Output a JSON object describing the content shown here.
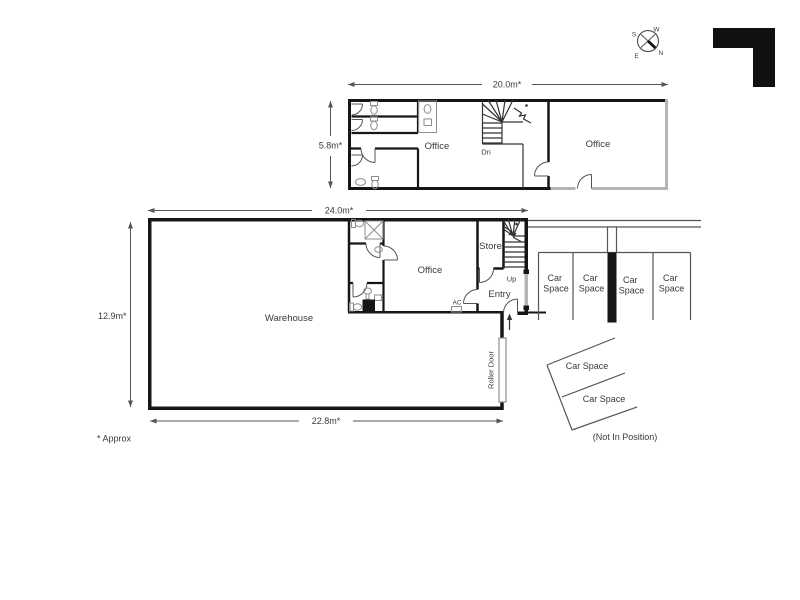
{
  "compass": {
    "s": "S",
    "w": "W",
    "e": "E",
    "n": "N"
  },
  "upper_floor": {
    "width_dim": "20.0m*",
    "height_dim": "5.8m*",
    "office_left": "Office",
    "office_right": "Office",
    "stairs": "Dn"
  },
  "ground_floor": {
    "width_dim": "24.0m*",
    "height_dim": "12.9m*",
    "bottom_dim": "22.8m*",
    "warehouse": "Warehouse",
    "office": "Office",
    "store": "Store",
    "entry": "Entry",
    "stairs": "Up",
    "ac": "AC",
    "roller_door": "Roller Door"
  },
  "parking": {
    "stalls": [
      {
        "l1": "Car",
        "l2": "Space"
      },
      {
        "l1": "Car",
        "l2": "Space"
      },
      {
        "l1": "Car",
        "l2": "Space"
      },
      {
        "l1": "Car",
        "l2": "Space"
      }
    ],
    "angled": [
      "Car Space",
      "Car Space"
    ],
    "note": "(Not In Position)"
  },
  "footnote": "* Approx",
  "colors": {
    "wall": "#161616",
    "gray_wall": "#b5b5b5",
    "line": "#555555",
    "text": "#3a3a3a",
    "logo": "#111111"
  }
}
